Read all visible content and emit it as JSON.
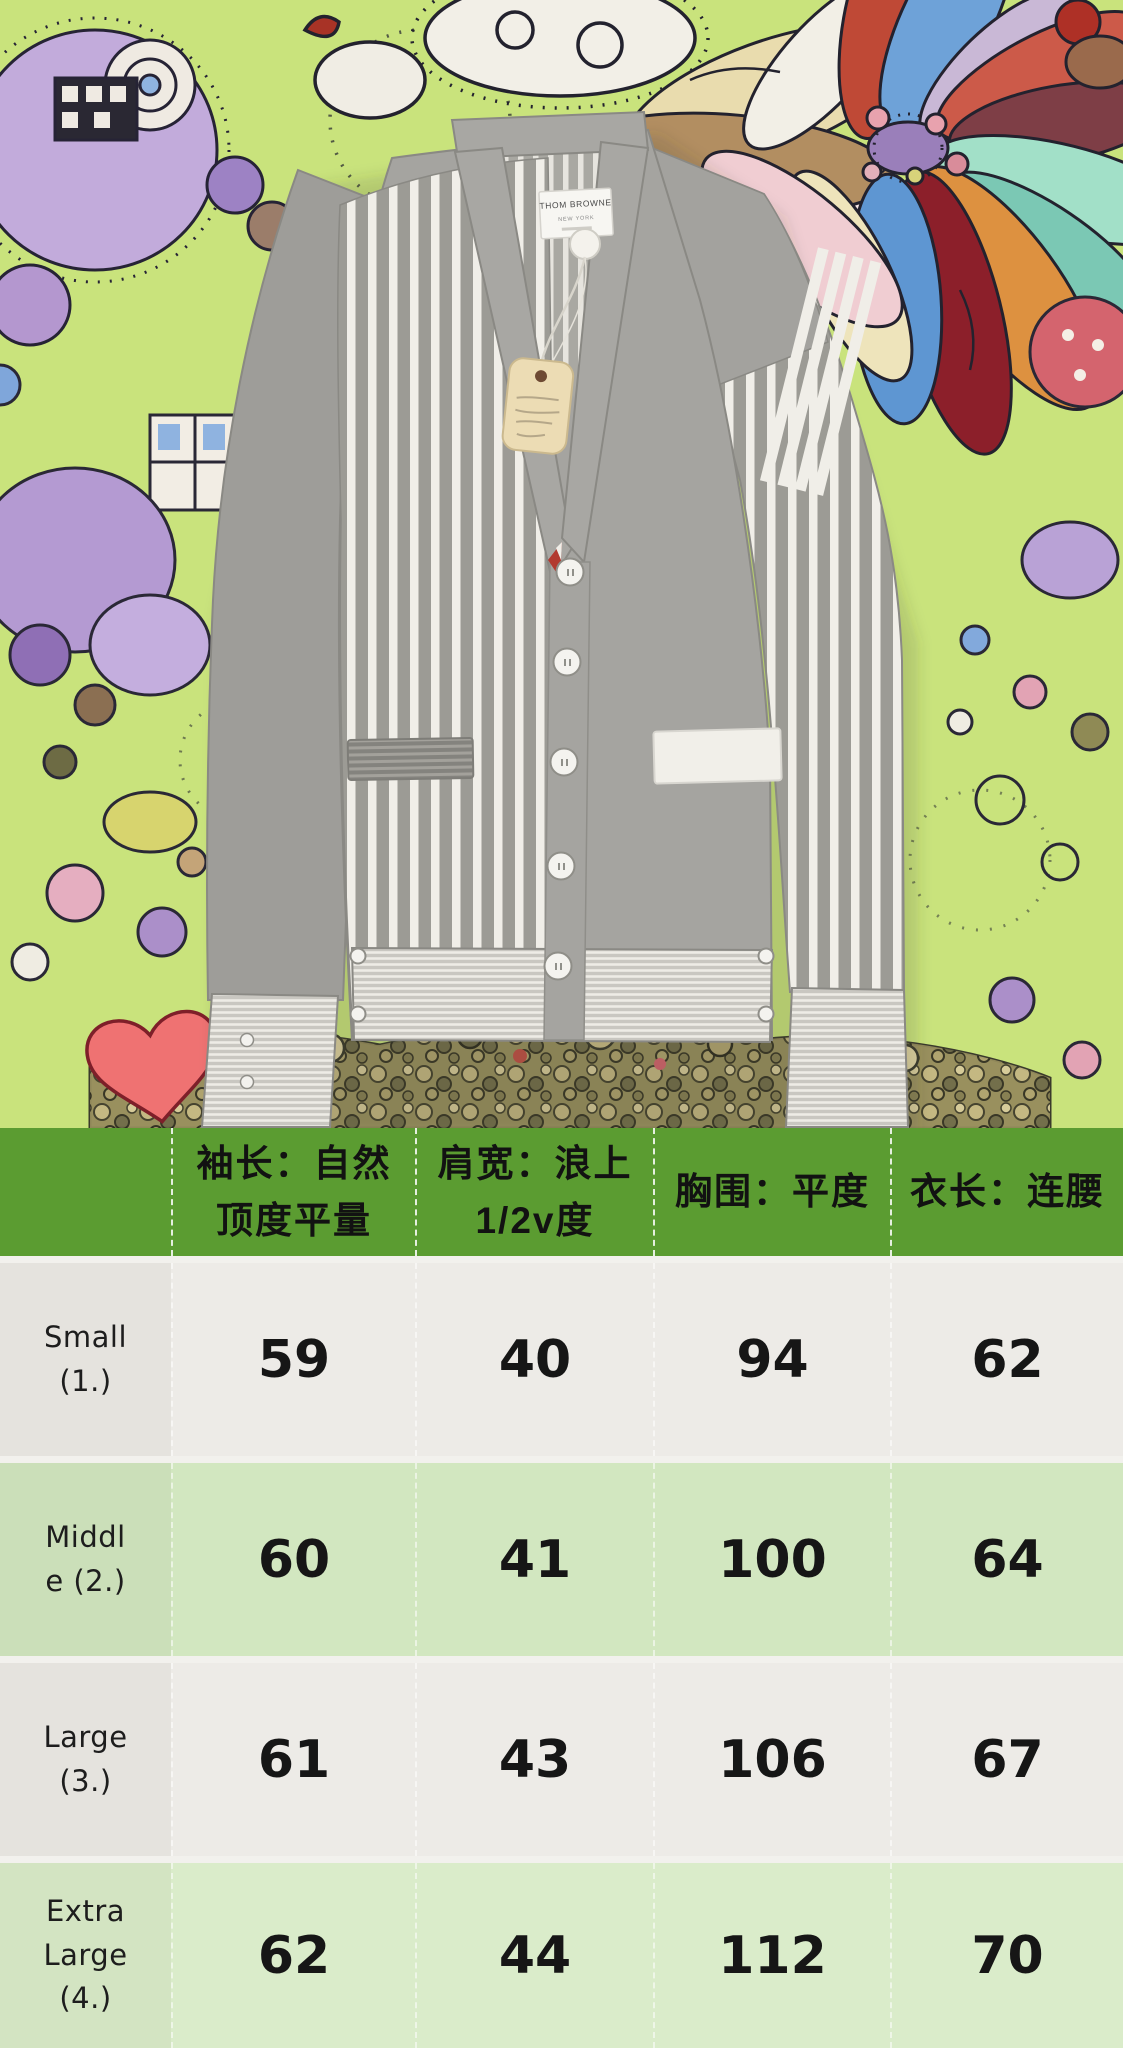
{
  "photo": {
    "brand_label": {
      "line1": "THOM BROWNE",
      "line2": "NEW YORK"
    },
    "garment": "grey striped v-neck cardigan with white 4-bar sleeve stripes",
    "accent_colors": {
      "background_green": "#c9e37c",
      "garment_grey": "#a5a4a0",
      "stripe_white": "#f0eee8",
      "placket_red": "#b23a30"
    }
  },
  "size_chart": {
    "colors": {
      "header_green": "#5b9c31",
      "row_offwhite": "#edebe7",
      "row_green": "#d2e7c0",
      "row_green_light": "#daecca"
    },
    "header": [
      "袖长：自然\n顶度平量",
      "肩宽：浪上\n1/2v度",
      "胸围：平度",
      "衣长：连腰"
    ],
    "rows": [
      {
        "label": "Small\n(1.)",
        "values": [
          "59",
          "40",
          "94",
          "62"
        ]
      },
      {
        "label": "Middl\ne (2.)",
        "values": [
          "60",
          "41",
          "100",
          "64"
        ]
      },
      {
        "label": "Large\n(3.)",
        "values": [
          "61",
          "43",
          "106",
          "67"
        ]
      },
      {
        "label": "Extra\nLarge\n(4.)",
        "values": [
          "62",
          "44",
          "112",
          "70"
        ]
      }
    ]
  },
  "chart_data": {
    "type": "table",
    "columns": [
      "size",
      "袖长：自然顶度平量",
      "肩宽：浪上1/2v度",
      "胸围：平度",
      "衣长：连腰"
    ],
    "rows": [
      [
        "Small (1.)",
        59,
        40,
        94,
        62
      ],
      [
        "Middle (2.)",
        60,
        41,
        100,
        64
      ],
      [
        "Large (3.)",
        61,
        43,
        106,
        67
      ],
      [
        "Extra Large (4.)",
        62,
        44,
        112,
        70
      ]
    ]
  }
}
